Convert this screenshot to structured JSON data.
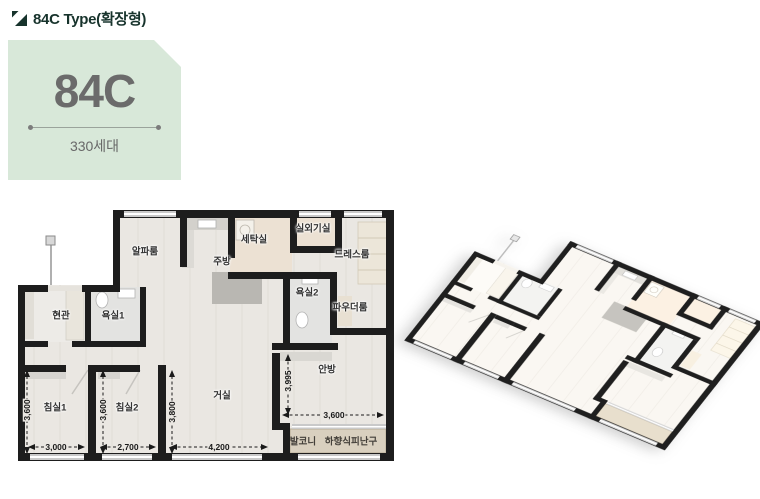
{
  "header": {
    "title": "84C Type(확장형)"
  },
  "card": {
    "type_label": "84C",
    "households": "330세대",
    "bg_color": "#d8e8d9",
    "text_color": "#6b6b6b"
  },
  "colors": {
    "accent_dark": "#17332c",
    "wall": "#1d1d1d",
    "floor": "#eae7e2",
    "wet_floor": "#ece1d3",
    "tile_floor": "#e3e3e1",
    "balcony_floor": "#d9d0bf"
  },
  "floorplan2d": {
    "rooms": {
      "alpha": "알파룸",
      "kitchen": "주방",
      "laundry": "세탁실",
      "outdoor_unit": "실외기실",
      "dressroom": "드레스룸",
      "bath2": "욕실2",
      "powder": "파우더룸",
      "entrance": "현관",
      "bath1": "욕실1",
      "bedroom1": "침실1",
      "bedroom2": "침실2",
      "living": "거실",
      "master": "안방",
      "balcony": "발코니",
      "escape_hatch": "하향식피난구"
    },
    "dimensions": {
      "bedroom1_h": "3,600",
      "bedroom2_h": "3,600",
      "living_h": "3,800",
      "master_h": "3,995",
      "bedroom1_w": "3,000",
      "bedroom2_w": "2,700",
      "living_w": "4,200",
      "master_w": "3,600"
    }
  }
}
